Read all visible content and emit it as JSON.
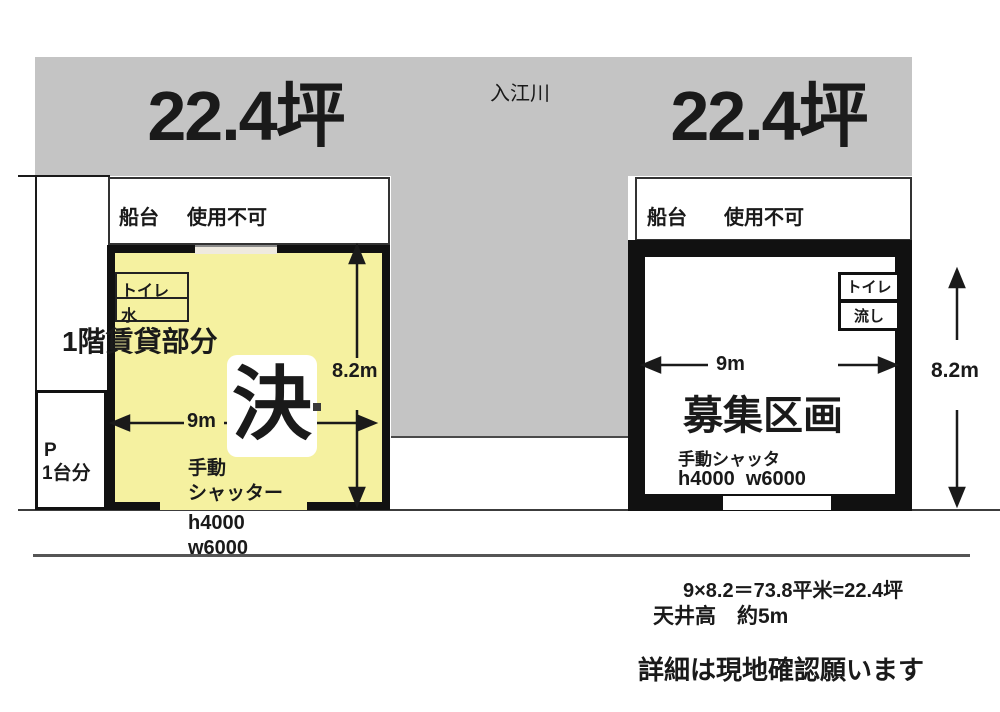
{
  "header": {
    "left_area_label": "22.4坪",
    "right_area_label": "22.4坪",
    "river_label": "入江川"
  },
  "left_unit": {
    "dock_label": "船台",
    "dock_status": "使用不可",
    "toilet_label": "トイレ",
    "water_label": "水",
    "floor_label": "1階賃貸部分",
    "sold_mark": "決",
    "width_dim": "9m",
    "height_dim": "8.2m",
    "shutter_line1": "手動",
    "shutter_line2": "シャッター",
    "shutter_height": "h4000",
    "shutter_width": "w6000",
    "parking_line1": "P",
    "parking_line2": "1台分"
  },
  "right_unit": {
    "dock_label": "船台",
    "dock_status": "使用不可",
    "toilet_label": "トイレ",
    "sink_label": "流し",
    "vacancy_label": "募集区画",
    "width_dim": "9m",
    "height_dim": "8.2m",
    "shutter_label": "手動シャッタ",
    "shutter_size": "h4000  w6000"
  },
  "footer": {
    "area_calc": "9×8.2＝73.8平米=22.4坪",
    "ceiling_height": "天井高　約5m",
    "note": "詳細は現地確認願います"
  },
  "colors": {
    "highlight_yellow": "#f5f1a0",
    "band_gray": "#c4c4c4",
    "line_black": "#1a1a1a"
  }
}
